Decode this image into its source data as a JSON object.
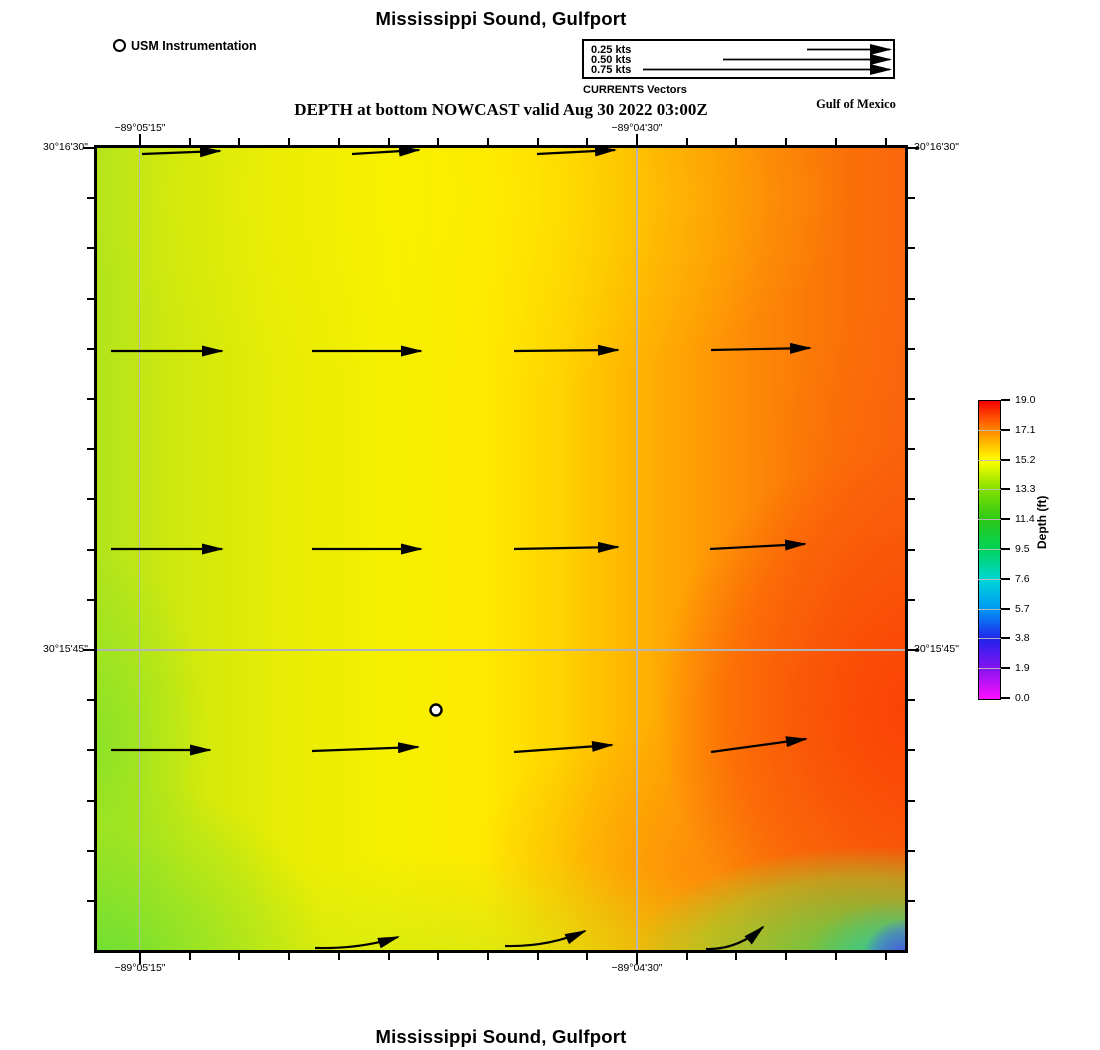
{
  "titles": {
    "top": "Mississippi Sound, Gulfport",
    "subtitle": "DEPTH at bottom NOWCAST valid Aug 30 2022 03:00Z",
    "region_label": "Gulf of Mexico",
    "bottom": "Mississippi Sound, Gulfport"
  },
  "station": {
    "label": "USM Instrumentation"
  },
  "currents_legend": {
    "caption": "CURRENTS Vectors",
    "items": [
      {
        "label": "0.25 kts",
        "tail_x": 223
      },
      {
        "label": "0.50 kts",
        "tail_x": 139
      },
      {
        "label": "0.75 kts",
        "tail_x": 59
      }
    ]
  },
  "axes": {
    "lon": [
      {
        "label": "−89°05'15\"",
        "x": 140
      },
      {
        "label": "−89°04'30\"",
        "x": 637
      }
    ],
    "lat": [
      {
        "label": "30°16'30\"",
        "y": 148
      },
      {
        "label": "30°15'45\"",
        "y": 650
      }
    ]
  },
  "colorbar": {
    "label": "Depth (ft)",
    "ticks": [
      "19.0",
      "17.1",
      "15.2",
      "13.3",
      "11.4",
      "9.5",
      "7.6",
      "5.7",
      "3.8",
      "1.9",
      "0.0"
    ]
  },
  "chart_data": {
    "type": "heatmap",
    "title": "Mississippi Sound, Gulfport",
    "subtitle": "DEPTH at bottom NOWCAST valid Aug 30 2022 03:00Z",
    "region": "Gulf of Mexico",
    "xlabel_ticks": [
      "−89°05'15\"",
      "−89°04'30\""
    ],
    "ylabel_ticks": [
      "30°16'30\"",
      "30°15'45\""
    ],
    "colorbar_label": "Depth (ft)",
    "colorbar_ticks_ft": [
      19.0,
      17.1,
      15.2,
      13.3,
      11.4,
      9.5,
      7.6,
      5.7,
      3.8,
      1.9,
      0.0
    ],
    "colorbar_palette": [
      "#f80000",
      "#ff8a00",
      "#ffff00",
      "#7fdf00",
      "#2cc818",
      "#00d45c",
      "#00d6d6",
      "#0096f4",
      "#2222ee",
      "#8812f0",
      "#ff10ff"
    ],
    "field_summary": "Depth ≈13–15 ft (yellow-green) in the west, deepening eastward to ≈17–19 ft (orange-red); shallower ≈11–13 ft along the south and southwest edges and a ≈2–8 ft (green-cyan-blue) pocket at the extreme southeast corner",
    "legend_speeds_kts": [
      0.25,
      0.5,
      0.75
    ],
    "vectors": {
      "unit": "kts",
      "direction": "eastward, curving northeastward along the southern edge",
      "approx_speed_kts": 0.27,
      "arrows": [
        {
          "x1": 45,
          "y1": 6,
          "x2": 123,
          "y2": 3,
          "clipped": true
        },
        {
          "x1": 255,
          "y1": 6,
          "x2": 322,
          "y2": 2,
          "clipped": true
        },
        {
          "x1": 440,
          "y1": 6,
          "x2": 518,
          "y2": 2,
          "clipped": true
        },
        {
          "x1": 14,
          "y1": 203,
          "x2": 125,
          "y2": 203
        },
        {
          "x1": 215,
          "y1": 203,
          "x2": 324,
          "y2": 203
        },
        {
          "x1": 417,
          "y1": 203,
          "x2": 521,
          "y2": 202
        },
        {
          "x1": 614,
          "y1": 202,
          "x2": 713,
          "y2": 200
        },
        {
          "x1": 14,
          "y1": 401,
          "x2": 125,
          "y2": 401
        },
        {
          "x1": 215,
          "y1": 401,
          "x2": 324,
          "y2": 401
        },
        {
          "x1": 417,
          "y1": 401,
          "x2": 521,
          "y2": 399
        },
        {
          "x1": 613,
          "y1": 401,
          "x2": 708,
          "y2": 396
        },
        {
          "x1": 14,
          "y1": 602,
          "x2": 113,
          "y2": 602
        },
        {
          "x1": 215,
          "y1": 603,
          "x2": 321,
          "y2": 599
        },
        {
          "x1": 417,
          "y1": 604,
          "x2": 515,
          "y2": 597
        },
        {
          "x1": 614,
          "y1": 604,
          "x2": 709,
          "y2": 591
        },
        {
          "x1": 218,
          "y1": 800,
          "x2": 301,
          "y2": 789,
          "curved": true
        },
        {
          "x1": 408,
          "y1": 798,
          "x2": 488,
          "y2": 783,
          "curved": true
        },
        {
          "x1": 609,
          "y1": 801,
          "x2": 666,
          "y2": 779,
          "curved": true
        }
      ]
    },
    "station_marker": {
      "x": 339,
      "y": 562,
      "symbol": "white circle, black ring"
    },
    "gridlines": {
      "lon_px": [
        140,
        637
      ],
      "lat_px": [
        650
      ]
    }
  }
}
